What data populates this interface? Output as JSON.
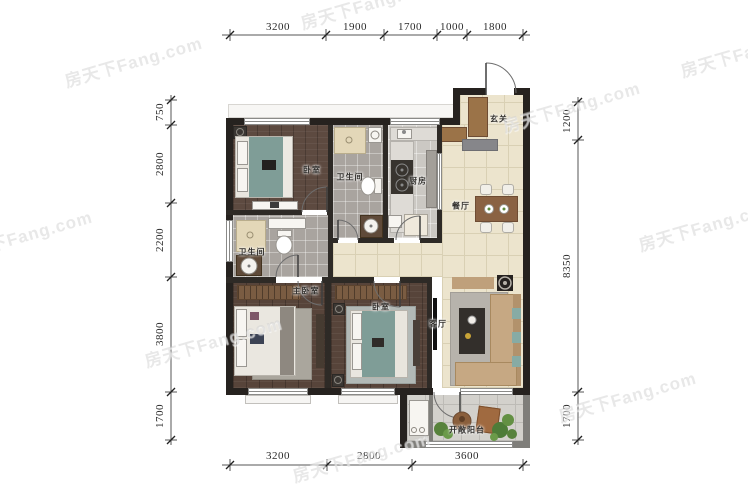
{
  "watermark": {
    "text": "房天下Fang.com"
  },
  "dimensions": {
    "top": [
      "3200",
      "1900",
      "1700",
      "1000",
      "1800"
    ],
    "bottom": [
      "3200",
      "2800",
      "3600"
    ],
    "left": [
      "750",
      "2800",
      "2200",
      "3800",
      "1700"
    ],
    "right": [
      "1200",
      "8350",
      "1700"
    ]
  },
  "rooms": {
    "bedroom_top": {
      "label": "卧室"
    },
    "bath_top": {
      "label": "卫生间"
    },
    "kitchen": {
      "label": "厨房"
    },
    "entry": {
      "label": "玄关"
    },
    "dining": {
      "label": "餐厅"
    },
    "bath_left": {
      "label": "卫生间"
    },
    "master_bedroom": {
      "label": "主卧室"
    },
    "bedroom_bottom": {
      "label": "卧室"
    },
    "living": {
      "label": "客厅"
    },
    "balcony": {
      "label": "开敞阳台"
    }
  },
  "colors": {
    "wall": "#26221f",
    "wood_floor": "#57443a",
    "tile_beige": "#ece4cd",
    "tile_grey": "#a9a49f",
    "bed_teal": "#7f9d97",
    "sofa_tan": "#c6a883",
    "wood_furniture": "#8a6243",
    "plant_green": "#5d8a3c",
    "dimension_text": "#2b2b2b",
    "watermark_grey": "#c9c9c9"
  }
}
